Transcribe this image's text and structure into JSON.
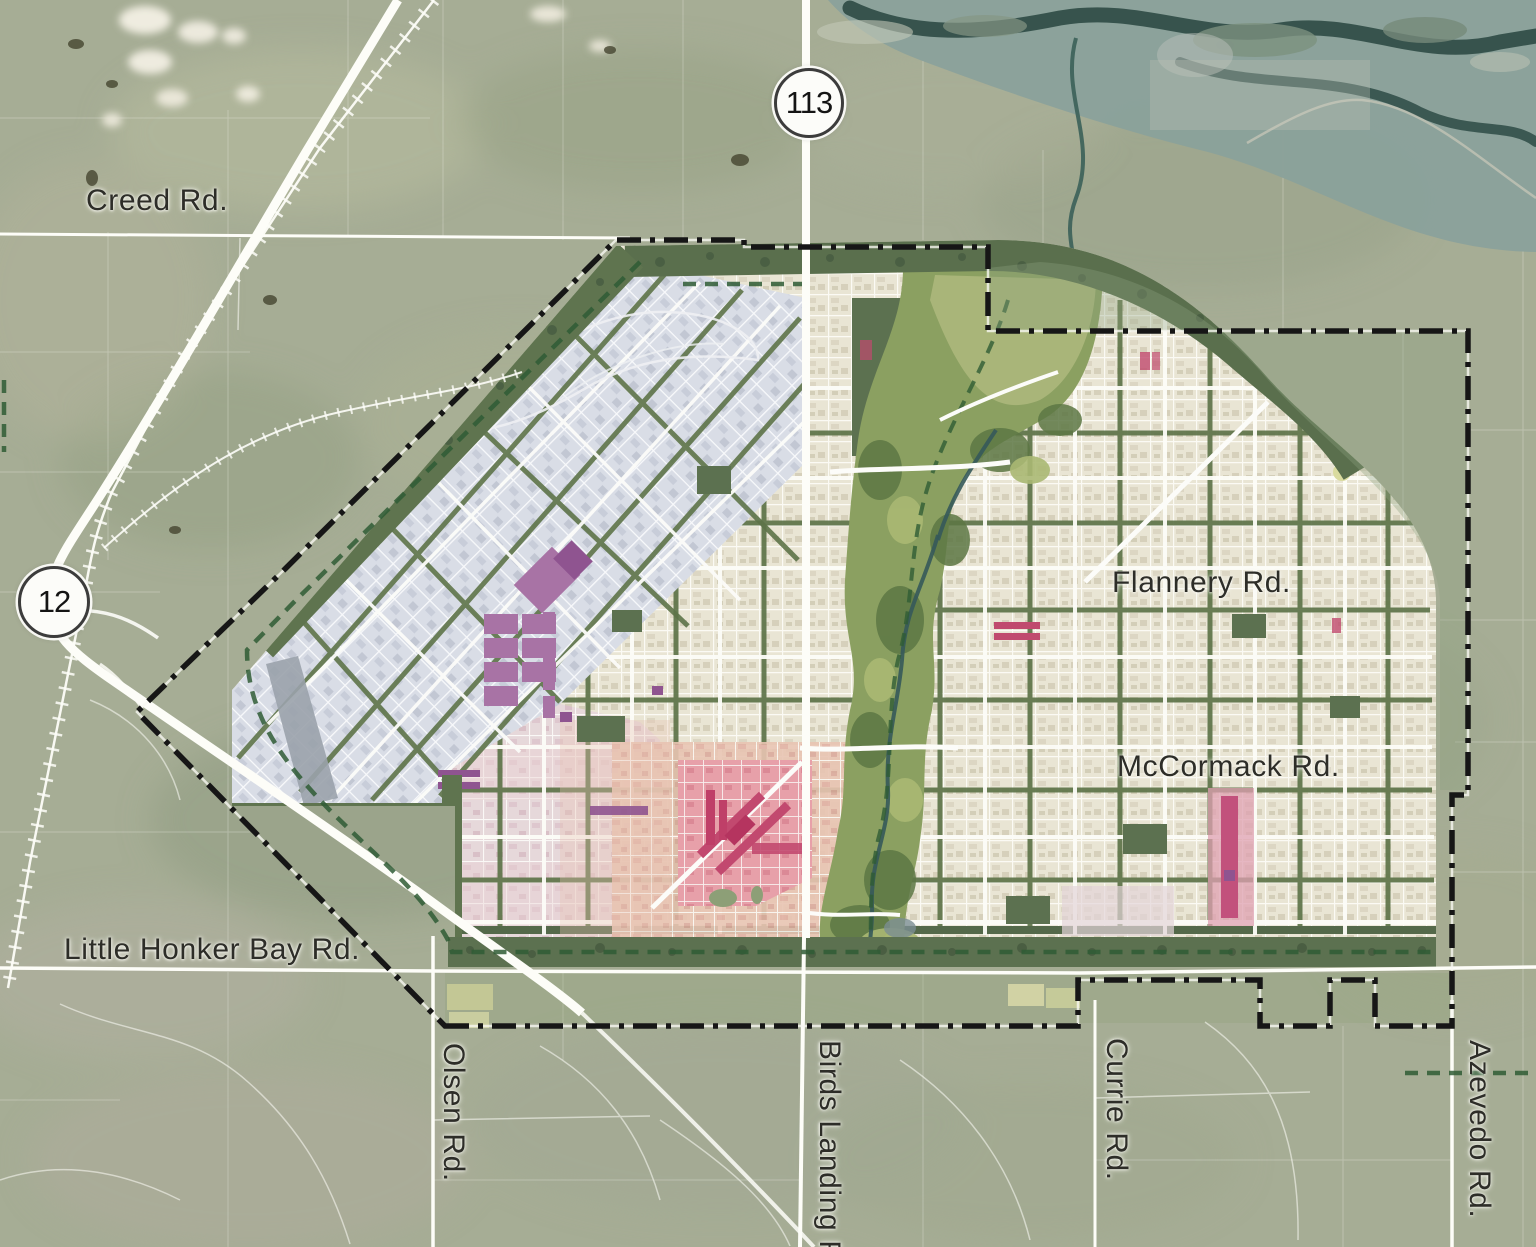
{
  "map": {
    "kind": "master-plan-satellite-map",
    "road_labels": {
      "creed": "Creed Rd.",
      "flannery": "Flannery Rd.",
      "mccormack": "McCormack Rd.",
      "little_honker_bay": "Little Honker Bay Rd.",
      "olsen": "Olsen Rd.",
      "birds_landing": "Birds Landing Rd.",
      "currie": "Currie Rd.",
      "azevedo": "Azevedo Rd."
    },
    "highway_shields": {
      "route_113": "113",
      "route_12": "12"
    },
    "colors": {
      "farmland": "#a6ad95",
      "water": "#8aa19b",
      "water_channel": "#2e4a45",
      "city_blocks": "#e9e5d4",
      "industrial_blocks": "#d9dde5",
      "downtown_pink": "#e8a9ae",
      "accent_crimson": "#c2496f",
      "accent_purple": "#a873a5",
      "greenway": "#8ba061",
      "boulevard_green": "#5e7449",
      "plan_boundary": "#161616",
      "trail_green": "#2f5c35",
      "roads": "#fdfdf8"
    }
  }
}
